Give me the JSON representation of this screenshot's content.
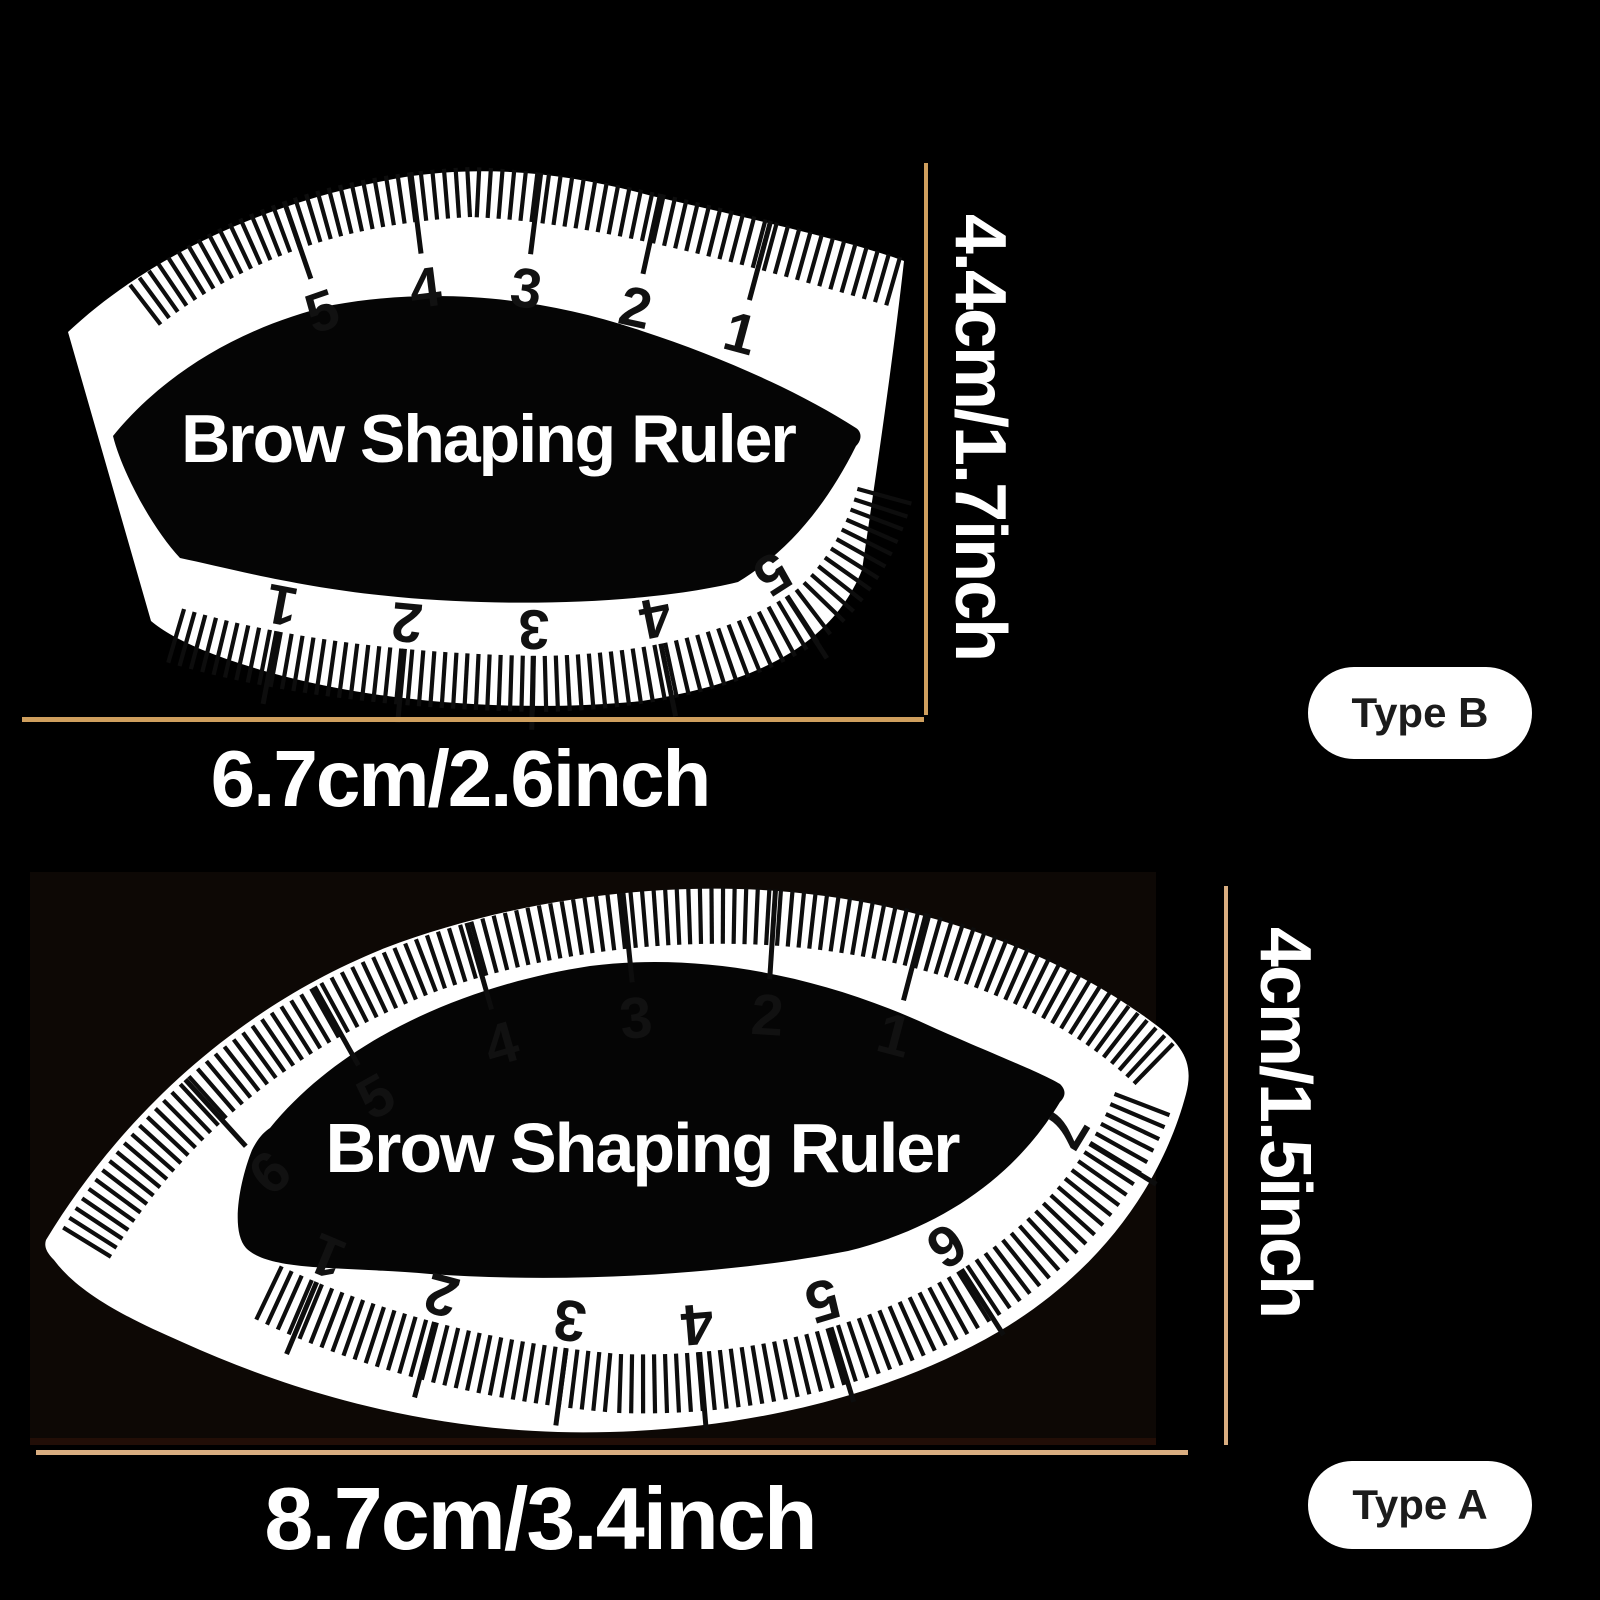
{
  "type_b": {
    "product_label": "Brow Shaping Ruler",
    "badge": "Type B",
    "height_label": "4.4cm/1.7inch",
    "width_label": "6.7cm/2.6inch",
    "top_scale_numbers": [
      "5",
      "4",
      "3",
      "2",
      "1"
    ],
    "bottom_scale_numbers": [
      "1",
      "2",
      "3",
      "4",
      "5"
    ]
  },
  "type_a": {
    "product_label": "Brow Shaping Ruler",
    "badge": "Type A",
    "height_label": "4cm/1.5inch",
    "width_label": "8.7cm/3.4inch",
    "top_scale_numbers": [
      "6",
      "5",
      "4",
      "3",
      "2",
      "1"
    ],
    "bottom_scale_numbers": [
      "1",
      "2",
      "3",
      "4",
      "5",
      "6",
      "7"
    ]
  },
  "colors": {
    "background": "#000000",
    "ruler_fill": "#ffffff",
    "ruler_hole": "#050505",
    "tick_color": "#0d0d0d",
    "scale_number_color": "#111111",
    "dimension_line_top": "#cf9f5e",
    "dimension_line_bottom": "#d9ad80",
    "badge_background": "#ffffff",
    "badge_text": "#1b1b1b"
  }
}
